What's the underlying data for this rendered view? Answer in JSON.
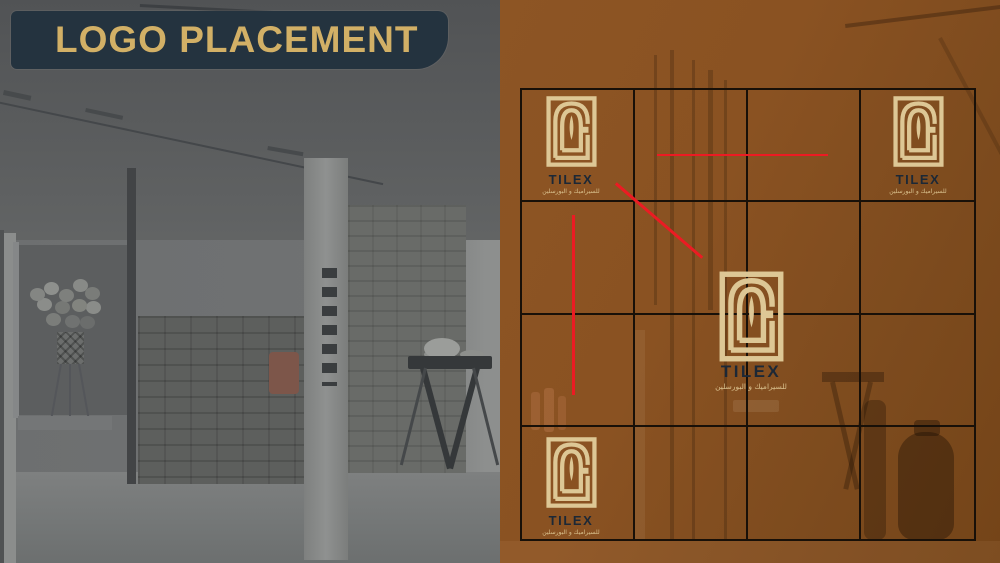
{
  "slide": {
    "title": "LOGO PLACEMENT"
  },
  "brand": {
    "name": "TILEX",
    "tagline_ar": "للسيراميك و البورسلين"
  },
  "grid": {
    "rows": 4,
    "cols": 4
  },
  "placements": [
    "top-left",
    "top-right",
    "center",
    "bottom-left"
  ],
  "guides": {
    "count": 3,
    "types": [
      "horizontal",
      "diagonal",
      "vertical"
    ],
    "color": "#ec1b23"
  },
  "colors": {
    "banner_bg": "#24333f",
    "banner_gold": "#d2b066",
    "overlay_brown": "#885022",
    "grid_line": "#181008",
    "guide_red": "#ec1b23",
    "logo_cream": "#ddc795",
    "logo_name_navy": "#1c2836"
  }
}
